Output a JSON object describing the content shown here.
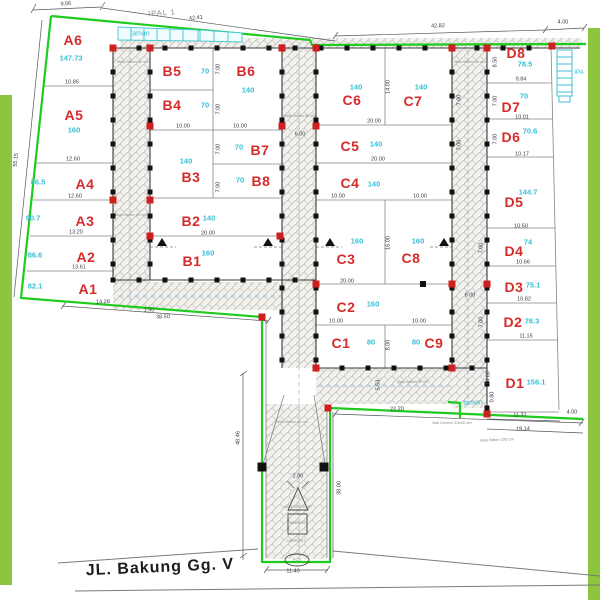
{
  "street": {
    "name": "JL. Bakung Gg. V"
  },
  "labels": {
    "ipal": "IPAL 1",
    "taman_top": "taman",
    "taman_bottom": "taman",
    "ipa": "IPA"
  },
  "colors": {
    "boundary_green": "#1ecb1e",
    "band_green": "#8cc63e",
    "plot_red": "#d62b2b",
    "area_cyan": "#35bfd4",
    "dim_gray": "#3a3a42",
    "column_red": "#cf1f1f",
    "column_black": "#111111"
  },
  "plots": [
    {
      "id": "A6",
      "area": "147.73",
      "lx": 73,
      "ly": 40,
      "ax": 71,
      "ay": 58
    },
    {
      "id": "A5",
      "area": "160",
      "lx": 74,
      "ly": 115,
      "ax": 74,
      "ay": 130
    },
    {
      "id": "A4",
      "area": "86.5",
      "lx": 85,
      "ly": 184,
      "ax": 38,
      "ay": 182
    },
    {
      "id": "A3",
      "area": "90.7",
      "lx": 85,
      "ly": 221,
      "ax": 33,
      "ay": 218
    },
    {
      "id": "A2",
      "area": "86.6",
      "lx": 86,
      "ly": 257,
      "ax": 35,
      "ay": 255
    },
    {
      "id": "A1",
      "area": "82.1",
      "lx": 88,
      "ly": 289,
      "ax": 35,
      "ay": 286
    },
    {
      "id": "B5",
      "area": "70",
      "lx": 172,
      "ly": 71,
      "ax": 205,
      "ay": 71
    },
    {
      "id": "B6",
      "area": "140",
      "lx": 246,
      "ly": 71,
      "ax": 248,
      "ay": 90
    },
    {
      "id": "B4",
      "area": "70",
      "lx": 172,
      "ly": 105,
      "ax": 205,
      "ay": 105
    },
    {
      "id": "B7",
      "area": "70",
      "lx": 260,
      "ly": 150,
      "ax": 239,
      "ay": 147
    },
    {
      "id": "B3",
      "area": "140",
      "lx": 191,
      "ly": 177,
      "ax": 186,
      "ay": 161
    },
    {
      "id": "B8",
      "area": "70",
      "lx": 261,
      "ly": 181,
      "ax": 240,
      "ay": 180
    },
    {
      "id": "B2",
      "area": "140",
      "lx": 191,
      "ly": 221,
      "ax": 209,
      "ay": 218
    },
    {
      "id": "B1",
      "area": "160",
      "lx": 192,
      "ly": 261,
      "ax": 208,
      "ay": 253
    },
    {
      "id": "C6",
      "area": "140",
      "lx": 352,
      "ly": 100,
      "ax": 356,
      "ay": 87
    },
    {
      "id": "C7",
      "area": "140",
      "lx": 413,
      "ly": 101,
      "ax": 421,
      "ay": 87
    },
    {
      "id": "C5",
      "area": "140",
      "lx": 350,
      "ly": 146,
      "ax": 376,
      "ay": 144
    },
    {
      "id": "C4",
      "area": "140",
      "lx": 350,
      "ly": 183,
      "ax": 374,
      "ay": 184
    },
    {
      "id": "C3",
      "area": "160",
      "lx": 346,
      "ly": 259,
      "ax": 357,
      "ay": 241
    },
    {
      "id": "C8",
      "area": "160",
      "lx": 411,
      "ly": 258,
      "ax": 418,
      "ay": 241
    },
    {
      "id": "C2",
      "area": "160",
      "lx": 346,
      "ly": 307,
      "ax": 373,
      "ay": 304
    },
    {
      "id": "C1",
      "area": "80",
      "lx": 341,
      "ly": 343,
      "ax": 371,
      "ay": 342
    },
    {
      "id": "C9",
      "area": "80",
      "lx": 434,
      "ly": 343,
      "ax": 416,
      "ay": 342
    },
    {
      "id": "D8",
      "area": "78.5",
      "lx": 516,
      "ly": 53,
      "ax": 525,
      "ay": 64
    },
    {
      "id": "D7",
      "area": "70",
      "lx": 511,
      "ly": 107,
      "ax": 524,
      "ay": 96
    },
    {
      "id": "D6",
      "area": "70.6",
      "lx": 511,
      "ly": 137,
      "ax": 530,
      "ay": 131
    },
    {
      "id": "D5",
      "area": "144.7",
      "lx": 514,
      "ly": 202,
      "ax": 528,
      "ay": 192
    },
    {
      "id": "D4",
      "area": "74",
      "lx": 514,
      "ly": 251,
      "ax": 528,
      "ay": 242
    },
    {
      "id": "D3",
      "area": "75.1",
      "lx": 514,
      "ly": 287,
      "ax": 533,
      "ay": 285
    },
    {
      "id": "D2",
      "area": "76.3",
      "lx": 513,
      "ly": 322,
      "ax": 532,
      "ay": 321
    },
    {
      "id": "D1",
      "area": "156.1",
      "lx": 515,
      "ly": 383,
      "ax": 536,
      "ay": 382
    }
  ],
  "dimensions": [
    {
      "v": "9.56",
      "x": 66,
      "y": 5,
      "r": -6
    },
    {
      "v": "42.41",
      "x": 196,
      "y": 19,
      "r": -6
    },
    {
      "v": "42.82",
      "x": 438,
      "y": 27,
      "r": -1
    },
    {
      "v": "4.00",
      "x": 563,
      "y": 23,
      "r": 0
    },
    {
      "v": "55.15",
      "x": 17,
      "y": 160,
      "r": -85
    },
    {
      "v": "10.86",
      "x": 72,
      "y": 83,
      "r": 0
    },
    {
      "v": "12.60",
      "x": 73,
      "y": 160,
      "r": 0
    },
    {
      "v": "12.60",
      "x": 75,
      "y": 197,
      "r": 0
    },
    {
      "v": "13.20",
      "x": 76,
      "y": 233,
      "r": 0
    },
    {
      "v": "13.61",
      "x": 79,
      "y": 268,
      "r": 0
    },
    {
      "v": "14.28",
      "x": 103,
      "y": 303,
      "r": -2
    },
    {
      "v": "38.50",
      "x": 163,
      "y": 318,
      "r": -2
    },
    {
      "v": "10.00",
      "x": 183,
      "y": 127,
      "r": 0
    },
    {
      "v": "10.00",
      "x": 240,
      "y": 127,
      "r": 0
    },
    {
      "v": "20.00",
      "x": 208,
      "y": 234,
      "r": 0
    },
    {
      "v": "7.00",
      "x": 219,
      "y": 69,
      "r": -90
    },
    {
      "v": "7.00",
      "x": 219,
      "y": 109,
      "r": -90
    },
    {
      "v": "7.00",
      "x": 219,
      "y": 149,
      "r": -90
    },
    {
      "v": "7.00",
      "x": 219,
      "y": 187,
      "r": -90
    },
    {
      "v": "6.00",
      "x": 300,
      "y": 135,
      "r": 0
    },
    {
      "v": "1.50",
      "x": 149,
      "y": 311,
      "r": 0
    },
    {
      "v": "20.00",
      "x": 374,
      "y": 122,
      "r": 0
    },
    {
      "v": "20.00",
      "x": 378,
      "y": 160,
      "r": 0
    },
    {
      "v": "10.00",
      "x": 338,
      "y": 197,
      "r": 0
    },
    {
      "v": "10.00",
      "x": 420,
      "y": 197,
      "r": 0
    },
    {
      "v": "20.00",
      "x": 347,
      "y": 282,
      "r": 0
    },
    {
      "v": "10.00",
      "x": 336,
      "y": 322,
      "r": 0
    },
    {
      "v": "10.00",
      "x": 419,
      "y": 322,
      "r": 0
    },
    {
      "v": "14.00",
      "x": 389,
      "y": 87,
      "r": -90
    },
    {
      "v": "16.00",
      "x": 389,
      "y": 243,
      "r": -90
    },
    {
      "v": "8.00",
      "x": 389,
      "y": 345,
      "r": -90
    },
    {
      "v": "7.00",
      "x": 460,
      "y": 100,
      "r": -90
    },
    {
      "v": "7.00",
      "x": 460,
      "y": 145,
      "r": -90
    },
    {
      "v": "6.00",
      "x": 470,
      "y": 296,
      "r": 0
    },
    {
      "v": "7.00",
      "x": 482,
      "y": 248,
      "r": -90
    },
    {
      "v": "7.00",
      "x": 482,
      "y": 322,
      "r": -90
    },
    {
      "v": "5.53",
      "x": 379,
      "y": 385,
      "r": -90
    },
    {
      "v": "14.00",
      "x": 489,
      "y": 378,
      "r": -90
    },
    {
      "v": "0.80",
      "x": 493,
      "y": 397,
      "r": -90
    },
    {
      "v": "9.84",
      "x": 521,
      "y": 80,
      "r": 0
    },
    {
      "v": "10.01",
      "x": 522,
      "y": 118,
      "r": 0
    },
    {
      "v": "10.17",
      "x": 522,
      "y": 155,
      "r": 0
    },
    {
      "v": "10.50",
      "x": 521,
      "y": 227,
      "r": 0
    },
    {
      "v": "10.66",
      "x": 523,
      "y": 263,
      "r": 0
    },
    {
      "v": "10.82",
      "x": 524,
      "y": 300,
      "r": 0
    },
    {
      "v": "11.15",
      "x": 526,
      "y": 337,
      "r": 0
    },
    {
      "v": "11.31",
      "x": 520,
      "y": 416,
      "r": -1
    },
    {
      "v": "19.14",
      "x": 523,
      "y": 430,
      "r": -2
    },
    {
      "v": "4.00",
      "x": 572,
      "y": 413,
      "r": 0
    },
    {
      "v": "8.50",
      "x": 496,
      "y": 62,
      "r": -90
    },
    {
      "v": "7.00",
      "x": 496,
      "y": 101,
      "r": -90
    },
    {
      "v": "7.00",
      "x": 496,
      "y": 139,
      "r": -90
    },
    {
      "v": "22.20",
      "x": 397,
      "y": 410,
      "r": -2
    },
    {
      "v": "48.46",
      "x": 239,
      "y": 438,
      "r": -90
    },
    {
      "v": "38.00",
      "x": 340,
      "y": 488,
      "r": -90
    },
    {
      "v": "11.40",
      "x": 293,
      "y": 572,
      "r": 0
    },
    {
      "v": "2.00",
      "x": 298,
      "y": 477,
      "r": 0
    }
  ],
  "notes": [
    {
      "v": "Buis Beton 40 cm",
      "x": 133,
      "y": 62,
      "r": 0
    },
    {
      "v": "Buis Beton 40 cm",
      "x": 131,
      "y": 215,
      "r": 0
    },
    {
      "v": "Buis Beton 40 cm",
      "x": 300,
      "y": 116,
      "r": 0
    },
    {
      "v": "Buis Beton 40 cm",
      "x": 470,
      "y": 62,
      "r": 0
    },
    {
      "v": "Buis Beton 40 cm",
      "x": 413,
      "y": 382,
      "r": -1
    },
    {
      "v": "Buis Beton 40 cm",
      "x": 292,
      "y": 422,
      "r": 0
    },
    {
      "v": "Bak Kontrol 40x40 cm",
      "x": 452,
      "y": 423,
      "r": 0
    },
    {
      "v": "Buis Beton 100 cm",
      "x": 497,
      "y": 440,
      "r": -2
    },
    {
      "v": "MOTOR PUMP",
      "x": 298,
      "y": 507,
      "r": 0
    },
    {
      "v": "TANDON",
      "x": 297,
      "y": 523,
      "r": 0
    },
    {
      "v": "CARPORT",
      "x": 296,
      "y": 541,
      "r": 0
    },
    {
      "v": "POS",
      "x": 297,
      "y": 560,
      "r": 0
    }
  ],
  "red_columns": [
    [
      113,
      48
    ],
    [
      150,
      48
    ],
    [
      282,
      48
    ],
    [
      316,
      48
    ],
    [
      452,
      48
    ],
    [
      487,
      48
    ],
    [
      552,
      46
    ],
    [
      150,
      126
    ],
    [
      282,
      126
    ],
    [
      316,
      126
    ],
    [
      113,
      200
    ],
    [
      150,
      200
    ],
    [
      150,
      236
    ],
    [
      280,
      236
    ],
    [
      316,
      284
    ],
    [
      452,
      284
    ],
    [
      487,
      284
    ],
    [
      316,
      368
    ],
    [
      452,
      368
    ],
    [
      262,
      317
    ],
    [
      328,
      408
    ],
    [
      487,
      414
    ]
  ]
}
